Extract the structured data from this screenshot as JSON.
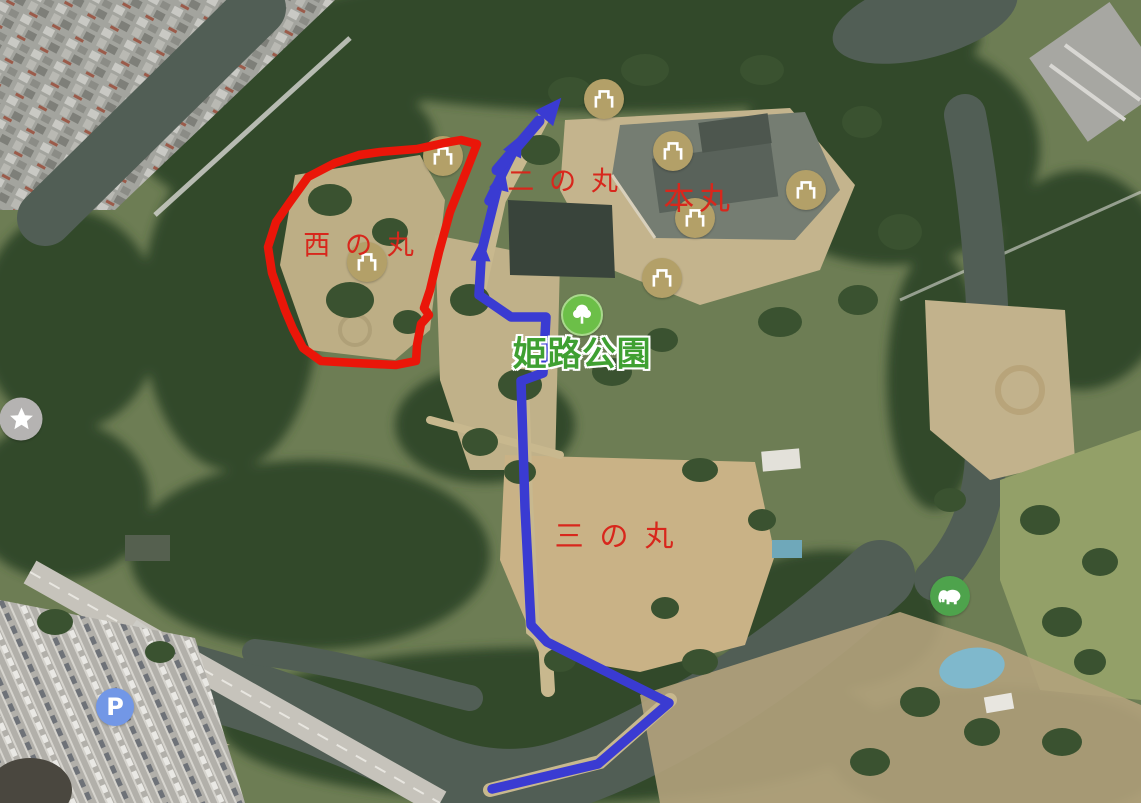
{
  "map": {
    "view": "satellite",
    "labels": {
      "nishinomaru": "西の丸",
      "ninomaru": "二の丸",
      "honmaru": "本丸",
      "sannomaru": "三の丸",
      "park": "姫路公園"
    },
    "markers": {
      "castle_marker_count": 7,
      "castle_icon": "castle-icon",
      "park_icon": "tree-icon",
      "favorite_icon": "star-icon",
      "parking_icon": "parking-icon",
      "parking_letter": "P",
      "zoo_icon": "elephant-icon"
    },
    "annotations": {
      "route": "blue walking route with arrows heading north",
      "area_outline": "red hand-drawn loop around Nishi-no-maru"
    },
    "colors": {
      "route_blue": "#3a3bd2",
      "outline_red": "#ea1609",
      "ward_label_red": "#d8271c",
      "park_label_green": "#3fa032",
      "castle_marker_tan": "#b3a068",
      "park_marker_green": "#6cbf48",
      "parking_marker_blue": "#7297e6",
      "zoo_marker_green": "#4ea34c",
      "favorite_marker_gray": "#b5b3b2"
    }
  }
}
